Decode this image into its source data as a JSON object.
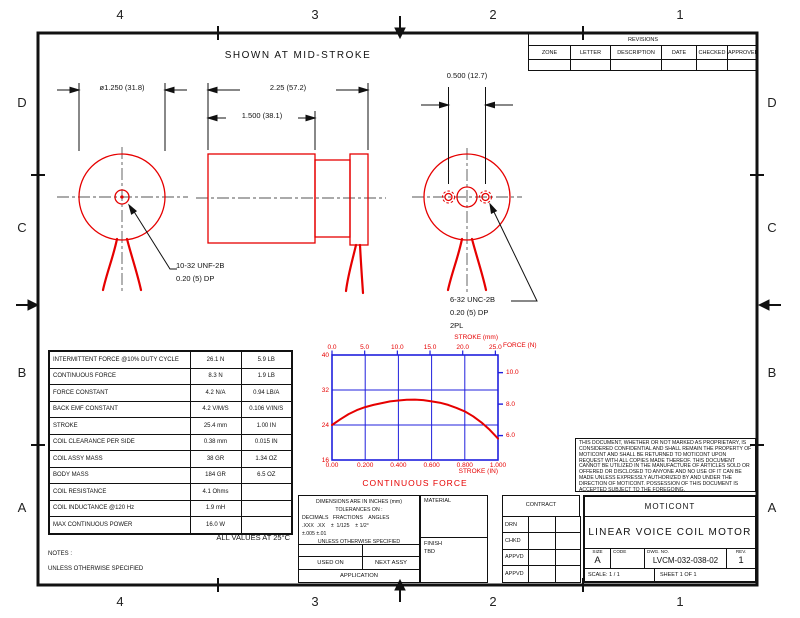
{
  "sheet_note": "SHOWN AT MID-STROKE",
  "zones": {
    "top": [
      "4",
      "3",
      "2",
      "1"
    ],
    "bottom": [
      "4",
      "3",
      "2",
      "1"
    ],
    "left": [
      "D",
      "C",
      "B",
      "A"
    ],
    "right": [
      "D",
      "C",
      "B",
      "A"
    ]
  },
  "revisions": {
    "title": "REVISIONS",
    "columns": [
      "ZONE",
      "LETTER",
      "DESCRIPTION",
      "DATE",
      "CHECKED",
      "APPROVED"
    ]
  },
  "dimensions": {
    "flange_diameter": "ø1.250 (31.8)",
    "overall_length": "2.25 (57.2)",
    "body_length": "1.500 (38.1)",
    "mount_hole_spacing": "0.500 (12.7)"
  },
  "callouts": {
    "shaft_thread": [
      "10-32 UNF-2B",
      "0.20 (5) DP"
    ],
    "mount_thread": [
      "6-32 UNC-2B",
      "0.20 (5) DP",
      "2PL"
    ]
  },
  "spec_table": {
    "rows": [
      [
        "INTERMITTENT FORCE @10% DUTY CYCLE",
        "26.1 N",
        "5.9 LB"
      ],
      [
        "CONTINUOUS FORCE",
        "8.3 N",
        "1.9 LB"
      ],
      [
        "FORCE CONSTANT",
        "4.2 N/A",
        "0.94 LB/A"
      ],
      [
        "BACK EMF CONSTANT",
        "4.2 V/M/S",
        "0.106 V/IN/S"
      ],
      [
        "STROKE",
        "25.4 mm",
        "1.00 IN"
      ],
      [
        "COIL CLEARANCE PER SIDE",
        "0.38 mm",
        "0.015 IN"
      ],
      [
        "COIL ASSY MASS",
        "38 GR",
        "1.34 OZ"
      ],
      [
        "BODY MASS",
        "184 GR",
        "6.5 OZ"
      ],
      [
        "COIL RESISTANCE",
        "4.1 Ohms",
        ""
      ],
      [
        "COIL INDUCTANCE @120 Hz",
        "1.9 mH",
        ""
      ],
      [
        "MAX CONTINUOUS POWER",
        "16.0 W",
        ""
      ]
    ],
    "footnote": "ALL VALUES AT 25°C"
  },
  "notes": {
    "heading": "NOTES :",
    "line1": "UNLESS OTHERWISE SPECIFIED"
  },
  "chart_data": {
    "type": "line",
    "title": "CONTINUOUS FORCE",
    "top_axis": {
      "label": "STROKE (mm)",
      "ticks": [
        "0.0",
        "5.0",
        "10.0",
        "15.0",
        "20.0",
        "25.0"
      ]
    },
    "bottom_axis": {
      "label": "STROKE (IN)",
      "ticks": [
        "0.00",
        "0.200",
        "0.400",
        "0.600",
        "0.800",
        "1.000"
      ]
    },
    "left_axis": {
      "ticks": [
        "40",
        "32",
        "24",
        "16"
      ],
      "range": [
        16,
        40
      ]
    },
    "right_axis": {
      "label": "FORCE (N)",
      "ticks": [
        "10.0",
        "8.0",
        "6.0"
      ]
    },
    "grid": true,
    "legend": "none",
    "series": [
      {
        "name": "CONTINUOUS FORCE",
        "x_stroke_in": [
          0,
          0.05,
          0.1,
          0.15,
          0.2,
          0.25,
          0.3,
          0.35,
          0.4,
          0.45,
          0.5,
          0.55,
          0.6,
          0.65,
          0.7,
          0.75,
          0.8,
          0.85,
          0.9,
          0.95,
          1.0
        ],
        "y_force_left_scale": [
          24,
          25.3,
          26.5,
          27.4,
          28.1,
          28.6,
          29.0,
          29.4,
          29.6,
          29.75,
          29.8,
          29.7,
          29.4,
          29.1,
          28.6,
          27.9,
          27.1,
          26.0,
          24.6,
          22.9,
          20.9
        ]
      }
    ]
  },
  "confidentiality": "THIS DOCUMENT, WHETHER OR NOT MARKED AS PROPRIETARY, IS CONSIDERED CONFIDENTIAL AND SHALL REMAIN THE PROPERTY OF MOTICONT AND SHALL BE RETURNED TO MOTICONT UPON REQUEST WITH ALL COPIES MADE THEREOF. THIS DOCUMENT CANNOT BE UTILIZED IN THE MANUFACTURE OF ARTICLES SOLD OR OFFERED OR DISCLOSED TO ANYONE AND NO USE OF IT CAN BE MADE UNLESS EXPRESSLY AUTHORIZED BY AND UNDER THE DIRECTION OF MOTICONT. POSSESSION OF THIS DOCUMENT IS ACCEPTED SUBJECT TO THE FOREGOING.",
  "tolerance_block": {
    "line1": "DIMENSIONS ARE IN INCHES (mm)",
    "line2": "TOLERANCES ON :",
    "line3": "DECIMALS   FRACTIONS    ANGLES",
    "line4": ".XXX  .XX    ±  1/125    ± 1/2°",
    "line5": "±.005 ±.01",
    "line6": "UNLESS OTHERWISE SPECIFIED",
    "used_on": "USED ON",
    "next_assy": "NEXT ASSY",
    "application": "APPLICATION"
  },
  "material_block": {
    "material_label": "MATERIAL",
    "finish_label": "FINISH",
    "finish_value": "TBD"
  },
  "contract_block": {
    "label": "CONTRACT",
    "rows": [
      "DRN",
      "CHKD",
      "APPVD",
      "APPVD"
    ]
  },
  "title_block": {
    "company": "MOTICONT",
    "title": "LINEAR VOICE COIL MOTOR",
    "size_label": "SIZE",
    "size_value": "A",
    "code_label": "CODE",
    "code_value": "",
    "dwg_label": "DWG. NO.",
    "dwg_no": "LVCM-032-038-02",
    "rev_label": "REV.",
    "rev_value": "1",
    "scale_label": "SCALE:",
    "scale_value": "1 / 1",
    "sheet_text": "SHEET  1  OF  1"
  },
  "colors": {
    "geometry_red": "#e60000",
    "chart_blue": "#2020dd",
    "line_black": "#111111"
  }
}
